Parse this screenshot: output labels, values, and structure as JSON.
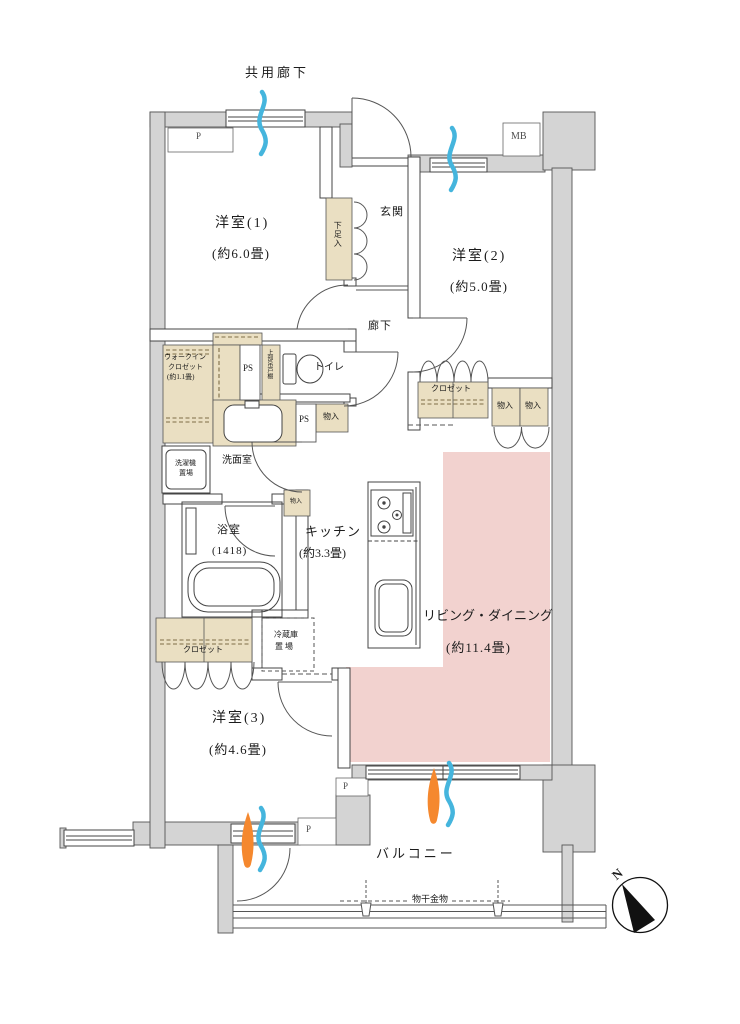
{
  "labels": {
    "common_corridor": "共用廊下",
    "pipe_p": "P",
    "room1_name": "洋室(1)",
    "room1_size": "(約6.0畳)",
    "room2_name": "洋室(2)",
    "room2_size": "(約5.0畳)",
    "room3_name": "洋室(3)",
    "room3_size": "(約4.6畳)",
    "entrance": "玄関",
    "shoe_cabinet": "下足入",
    "meter_box": "MB",
    "wic_line1": "ウォークイン",
    "wic_line2": "クロゼット",
    "wic_line3": "(約1.1畳)",
    "pipe_space": "PS",
    "upper_cabinet": "上部吊戸棚",
    "toilet": "トイレ",
    "hallway": "廊下",
    "closet": "クロゼット",
    "storage": "物入",
    "washroom": "洗面室",
    "laundry_line1": "洗濯機",
    "laundry_line2": "置場",
    "bathroom_name": "浴室",
    "bathroom_size": "(1418)",
    "kitchen_name": "キッチン",
    "kitchen_size": "(約3.3畳)",
    "living_dining_name": "リビング・ダイニング",
    "living_dining_size": "(約11.4畳)",
    "fridge_line1": "冷蔵庫",
    "fridge_line2": "置 場",
    "balcony": "バルコニー",
    "laundry_hardware": "物干金物",
    "compass_north": "N"
  },
  "colors": {
    "wall": "#d4d4d4",
    "fixture_tan": "#eadfc2",
    "living_dining_pink": "#f2d2cf",
    "vent_blue": "#45b5dd",
    "vent_orange": "#f5882e",
    "line": "#444444"
  }
}
